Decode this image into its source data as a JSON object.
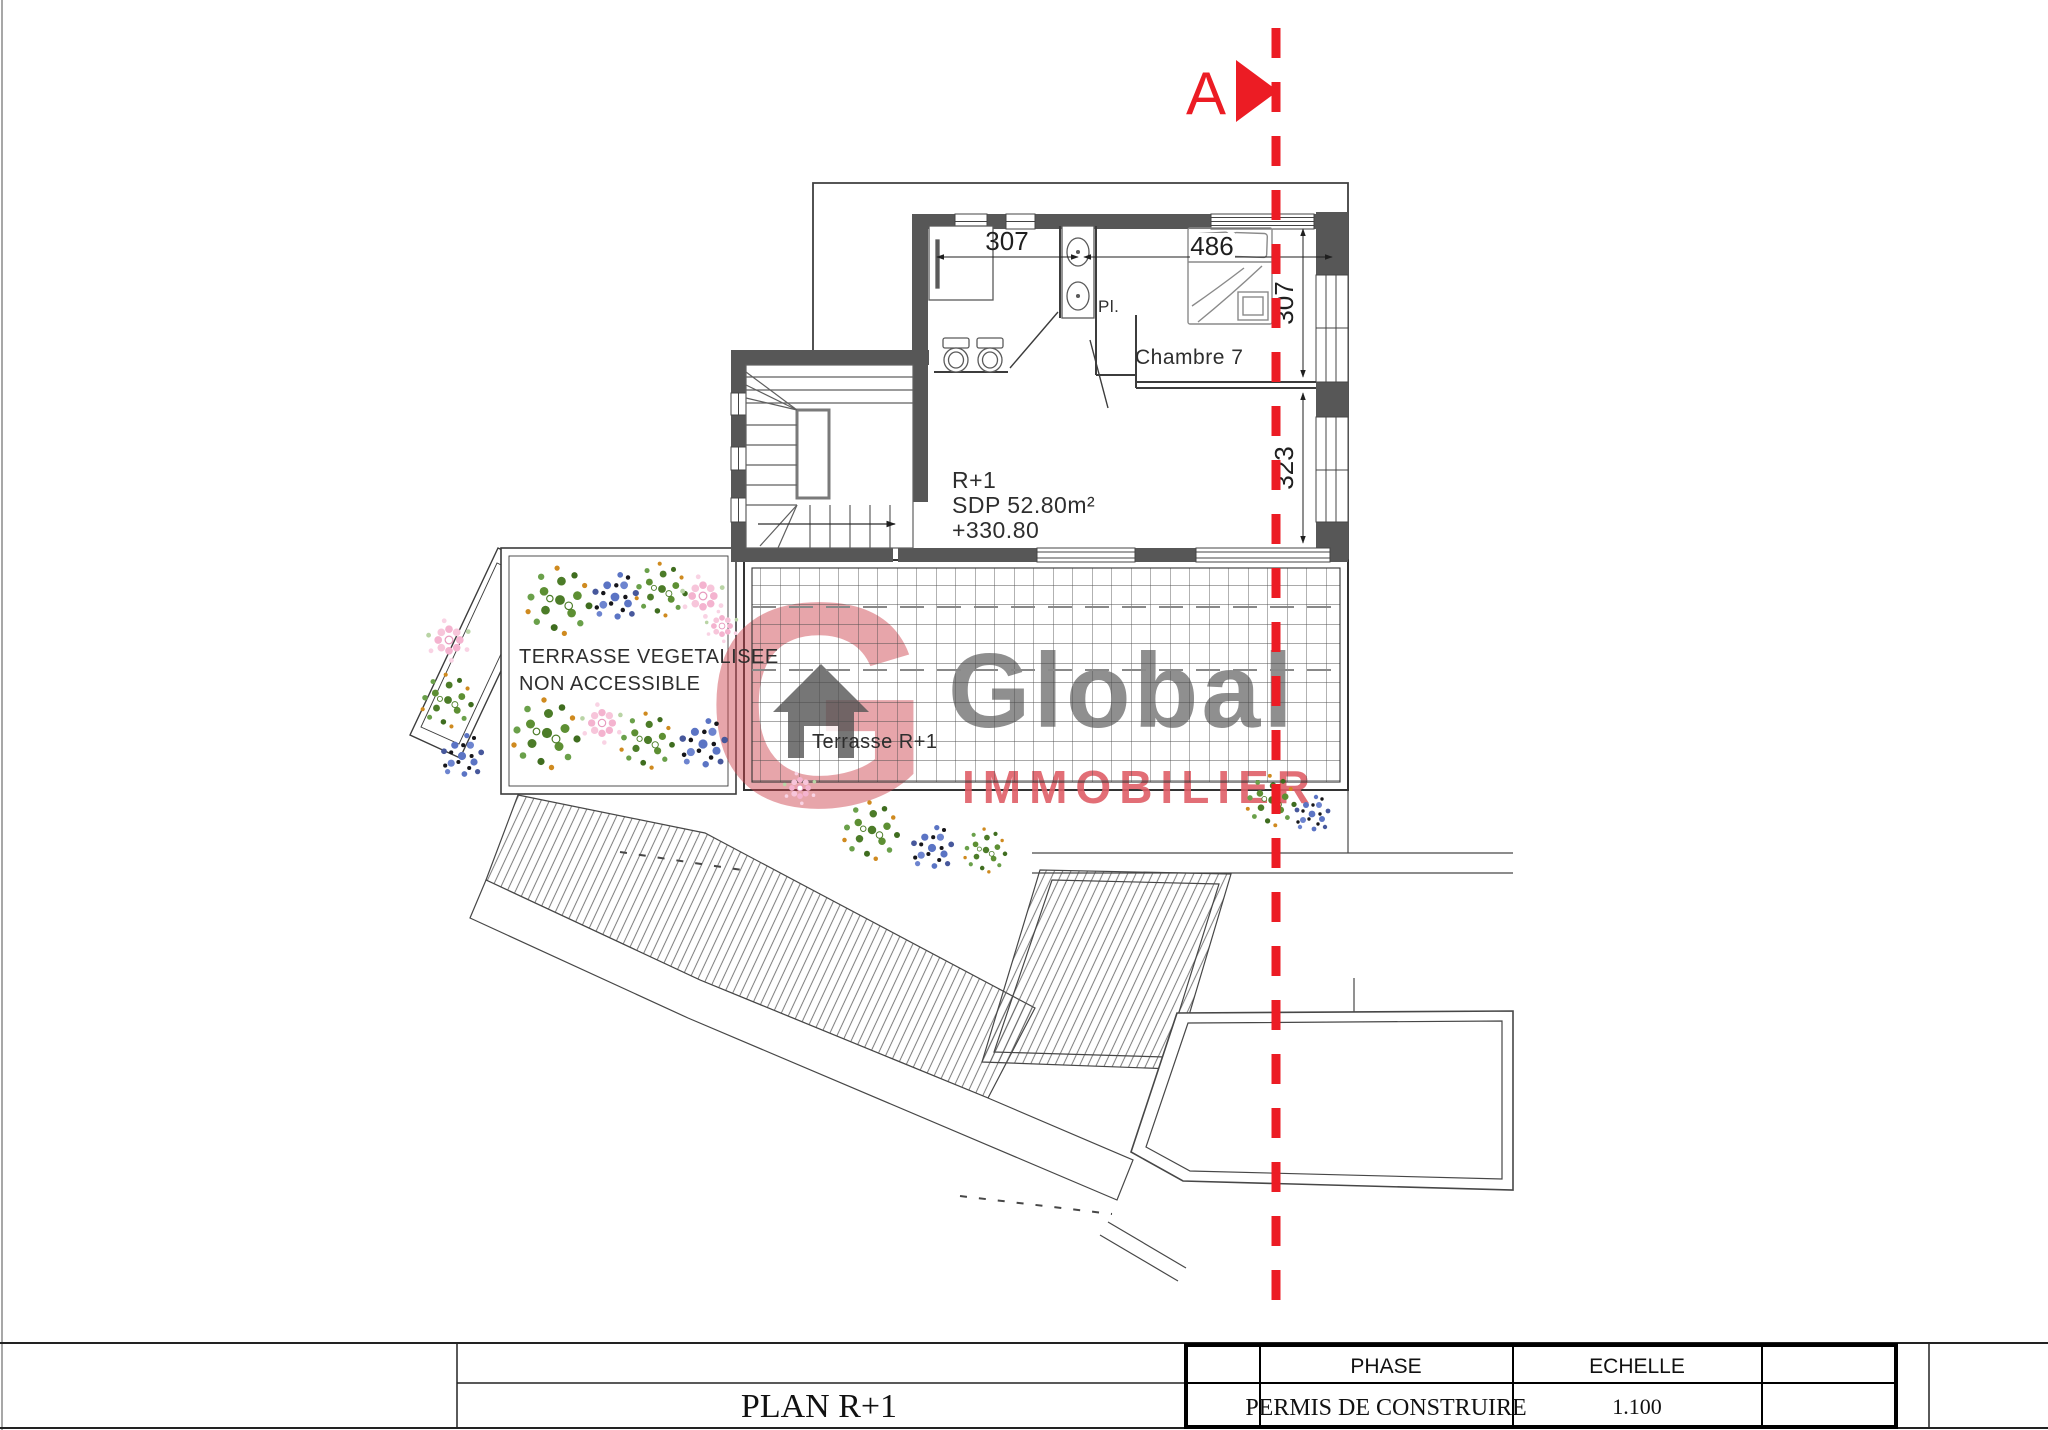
{
  "section_line": {
    "label": "A"
  },
  "dimensions": {
    "bath_width": "307",
    "bed_width": "486",
    "room_height_upper": "307",
    "room_height_lower": "323"
  },
  "rooms": {
    "closet": "Pl.",
    "bedroom": "Chambre 7",
    "level": "R+1",
    "floor_area": "SDP 52.80m²",
    "altitude": "+330.80",
    "green_terrace_line1": "TERRASSE VEGETALISEE",
    "green_terrace_line2": "NON ACCESSIBLE",
    "terrace": "Terrasse R+1"
  },
  "watermark": {
    "initial": "G",
    "name": "Global",
    "tagline": "IMMOBILIER"
  },
  "title_block": {
    "title": "PLAN R+1",
    "phase_label": "PHASE",
    "phase_value": "PERMIS DE CONSTRUIRE",
    "scale_label": "ECHELLE",
    "scale_value": "1.100"
  },
  "colors": {
    "wall": "#575757",
    "section_red": "#ec1c24",
    "watermark_gray": "#7c7c7c",
    "watermark_red": "#df5f68",
    "line": "#3c3c3c"
  }
}
